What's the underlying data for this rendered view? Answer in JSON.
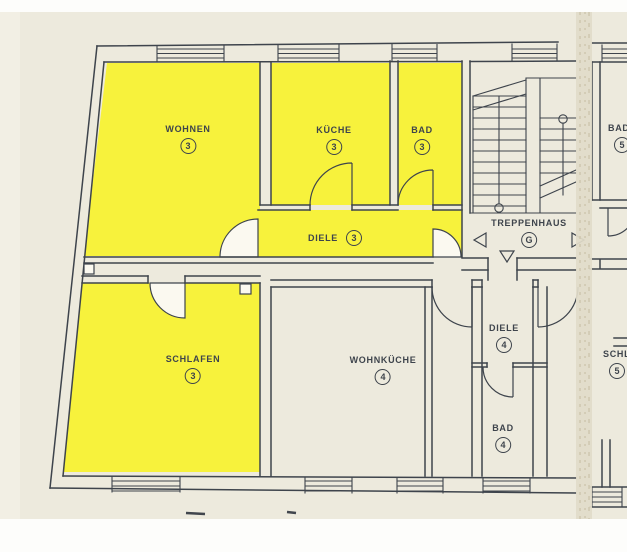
{
  "colors": {
    "paper": "#edeadd",
    "highlight": "#f7f23c",
    "line": "#3e444c",
    "fold": "#e1dcc9"
  },
  "rooms": {
    "wohnen": {
      "label": "WOHNEN",
      "number": "3"
    },
    "kueche": {
      "label": "KÜCHE",
      "number": "3"
    },
    "bad3": {
      "label": "BAD",
      "number": "3"
    },
    "diele3": {
      "label": "DIELE",
      "number": "3"
    },
    "schlafen": {
      "label": "SCHLAFEN",
      "number": "3"
    },
    "treppenhaus": {
      "label": "TREPPENHAUS",
      "number": "G"
    },
    "wohnkueche": {
      "label": "WOHNKÜCHE",
      "number": "4"
    },
    "diele4": {
      "label": "DIELE",
      "number": "4"
    },
    "bad4": {
      "label": "BAD",
      "number": "4"
    },
    "bad5": {
      "label": "BAD",
      "number": "5"
    },
    "room_right_partial": {
      "label": "SCHLAFEN",
      "number": "5"
    }
  }
}
